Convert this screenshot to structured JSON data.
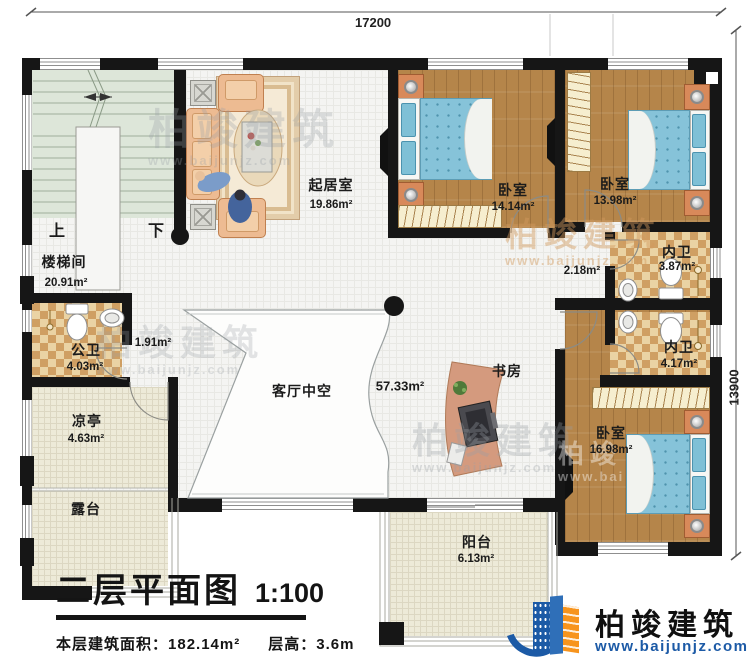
{
  "dimensions": {
    "width_mm": "17200",
    "height_mm": "13900"
  },
  "rooms": {
    "stairwell": {
      "name": "楼梯间",
      "area": "20.91m²"
    },
    "living": {
      "name": "起居室",
      "area": "19.86m²"
    },
    "bedroom_top_left": {
      "name": "卧室",
      "area": "14.14m²"
    },
    "bedroom_top_right": {
      "name": "卧室",
      "area": "13.98m²"
    },
    "bath_inner_top": {
      "name": "内卫",
      "area": "3.87m²"
    },
    "bath_inner_bottom": {
      "name": "内卫",
      "area": "4.17m²"
    },
    "bedroom_bottom": {
      "name": "卧室",
      "area": "16.98m²"
    },
    "bath_public": {
      "name": "公卫",
      "area": "4.03m²"
    },
    "pavilion": {
      "name": "凉亭",
      "area": "4.63m²"
    },
    "terrace": {
      "name": "露台"
    },
    "void": {
      "name": "客厅中空",
      "area": "57.33m²"
    },
    "study": {
      "name": "书房"
    },
    "balcony": {
      "name": "阳台",
      "area": "6.13m²"
    },
    "corridor_small": {
      "area": "2.18m²"
    },
    "hall_small": {
      "area": "1.91m²"
    }
  },
  "stairs": {
    "up": "上",
    "down": "下"
  },
  "title": {
    "text": "二层平面图",
    "scale": "1:100",
    "area_label": "本层建筑面积：",
    "area_value": "182.14m²",
    "height_label": "层高：",
    "height_value": "3.6m"
  },
  "branding": {
    "company": "柏竣建筑",
    "website": "www.baijunjz.com"
  },
  "colors": {
    "wall": "#161616",
    "wood": "#b5854a",
    "bed_blue": "#86c3d9",
    "checker_light": "#ead3a4",
    "checker_dark": "#cf9f63",
    "brand_blue": "#1c5aa6",
    "brand_orange": "#f7941d"
  }
}
